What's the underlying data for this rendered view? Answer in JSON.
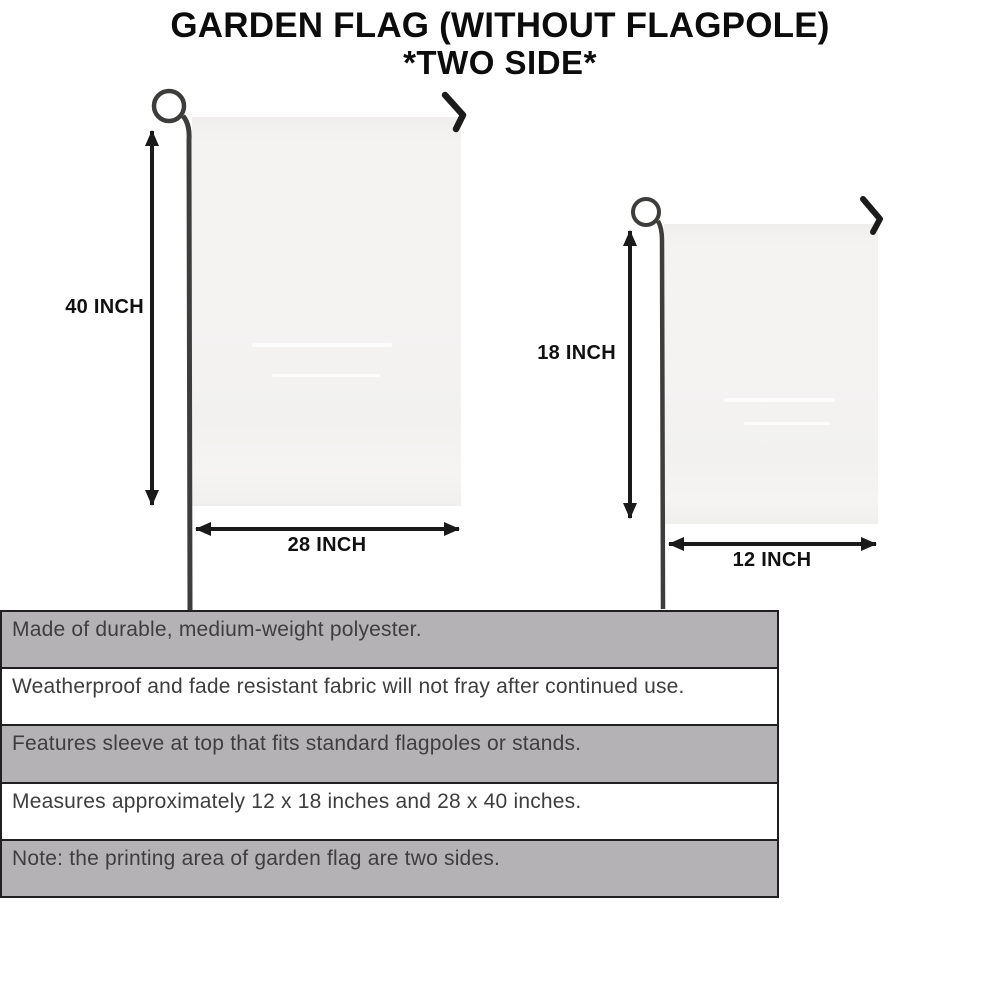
{
  "title": {
    "line1": "GARDEN FLAG (WITHOUT FLAGPOLE)",
    "line2": "*TWO SIDE*"
  },
  "diagram": {
    "large_flag": {
      "height_label": "40 INCH",
      "width_label": "28 INCH"
    },
    "small_flag": {
      "height_label": "18 INCH",
      "width_label": "12 INCH"
    }
  },
  "features": [
    "Made of durable, medium-weight polyester.",
    "Weatherproof and fade resistant fabric will not fray after continued use.",
    "Features sleeve at top that fits standard flagpoles or stands.",
    "Measures approximately 12 x 18 inches and 28 x 40 inches.",
    "Note: the printing area of garden flag are two sides."
  ],
  "colors": {
    "title_text": "#0c0c0c",
    "dimension_text": "#111111",
    "feature_text": "#3e3e3e",
    "shaded_row_bg": "#b5b2b5",
    "table_border": "#202020",
    "flag_fill": "#f4f3f2",
    "pole_stroke": "#3d3d3b",
    "hook_stroke": "#1b1b1b",
    "arrow_stroke": "#1a1a1a"
  }
}
